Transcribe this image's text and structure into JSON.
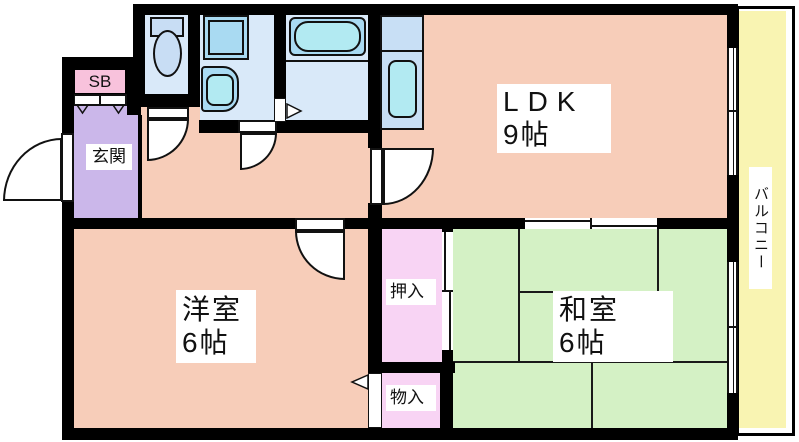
{
  "title": "apartment-floor-plan",
  "colors": {
    "wall": "#000000",
    "room_salmon": "#F7CDB9",
    "tatami_green": "#D4F1C5",
    "closet_pink": "#F8D4F4",
    "shoebox_pink": "#F8C2DC",
    "entrance_purple": "#CBB7EA",
    "wet_room_blue": "#D9E9F9",
    "fixture_blue": "#A9DAF2",
    "sink_cyan": "#B2EAF2",
    "balcony_yellow": "#F9F4B2",
    "label_bg": "#FFFFFF"
  },
  "rooms": {
    "ldk": {
      "name": "LDK",
      "size": "9帖"
    },
    "western_room": {
      "name": "洋室",
      "size": "6帖"
    },
    "japanese_room": {
      "name": "和室",
      "size": "6帖"
    },
    "entrance": {
      "label": "玄関"
    },
    "shoe_box": {
      "label": "SB"
    },
    "closet": {
      "label": "押入"
    },
    "storage": {
      "label": "物入"
    },
    "balcony": {
      "label": "バルコニー"
    }
  }
}
